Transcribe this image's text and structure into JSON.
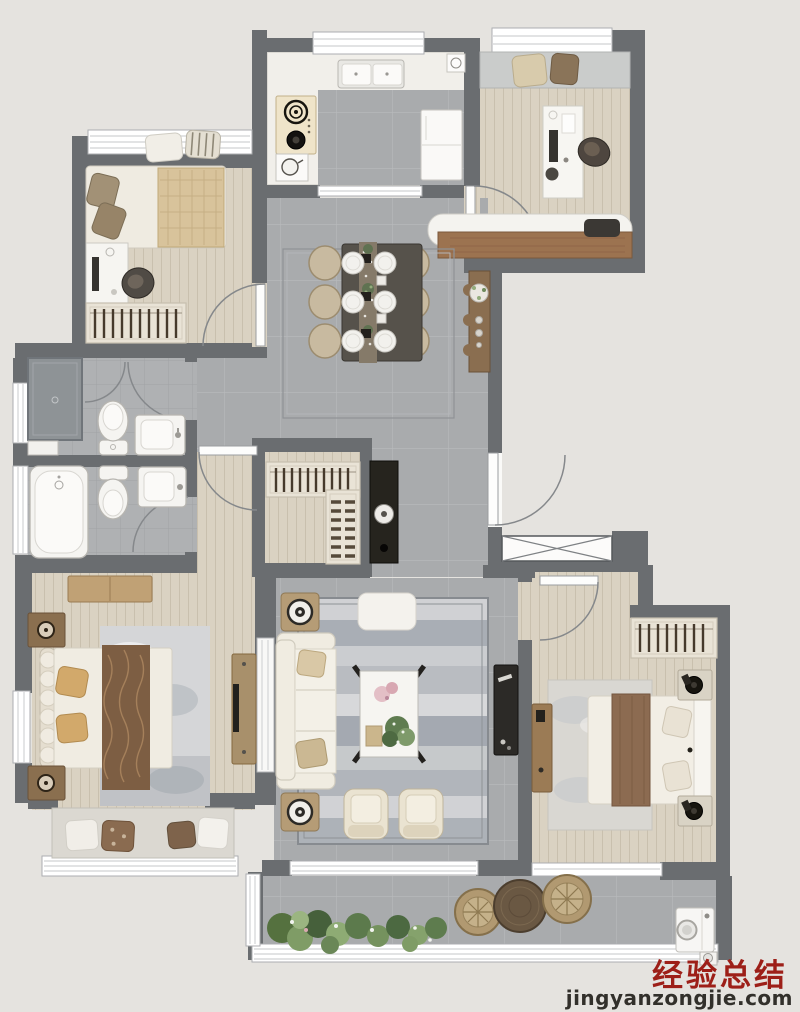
{
  "watermark": {
    "title": "经验总结",
    "domain": "jingyanzongjie.com"
  },
  "palette": {
    "background": "#E5E3DF",
    "wall": "#6A6D70",
    "wood": "#DAD2C2",
    "tile": "#A9ABAD",
    "bath_tile": "#AFB1B3",
    "marble": "#F1EFEA",
    "fixture": "#F5F4F1",
    "sofa": "#F0ECE1",
    "table_dark": "#56524B",
    "chair": "#C8BAA0",
    "wood_furn": "#9A7A56",
    "cabinet_dark": "#26241E",
    "plant": "#5F7C50",
    "wicker": "#B19971",
    "accent_brown": "#7D5E43",
    "rug": "#C0C3C6",
    "wm_red": "#9D1F18",
    "wm_dark": "#32302B"
  }
}
